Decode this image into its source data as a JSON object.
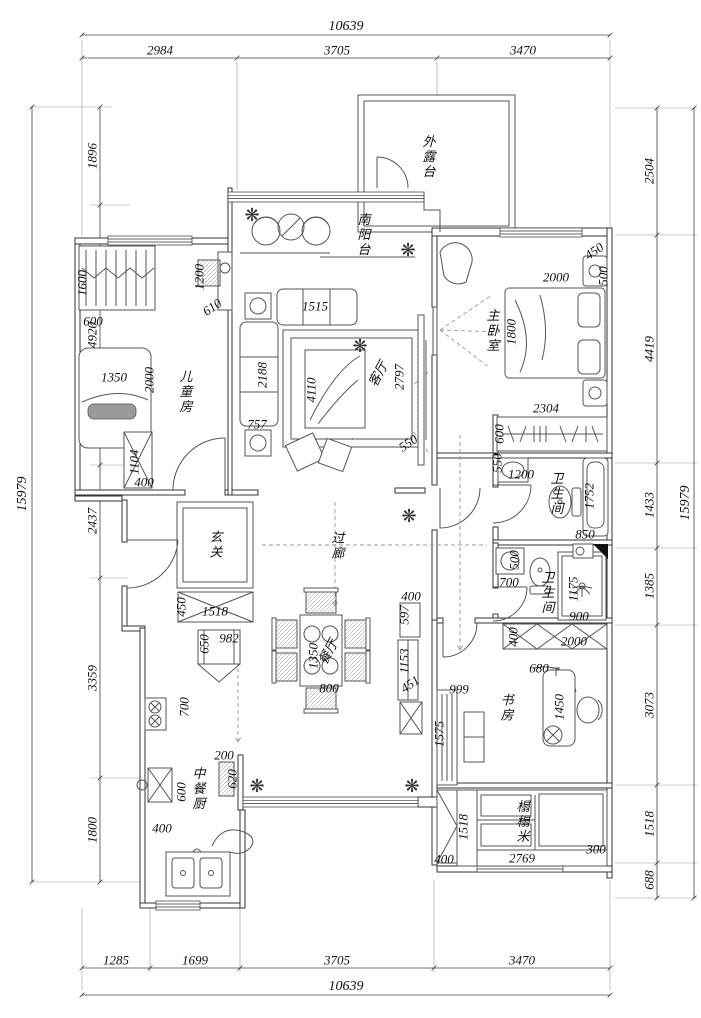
{
  "plan": {
    "rooms": {
      "terrace": "外露台",
      "balcony": "南阳台",
      "master": "主卧室",
      "kids": "儿童房",
      "living": "客厅",
      "entry": "玄关",
      "hall": "过廊",
      "bath_upper": "卫生间",
      "bath_lower": "卫生间",
      "dining": "餐厅",
      "study": "书房",
      "kitchen": "中餐厨",
      "tatami": "榻榻米"
    },
    "dims": {
      "top": {
        "total": "10639",
        "segs": [
          "2984",
          "3705",
          "3470"
        ]
      },
      "bottom": {
        "total": "10639",
        "segs": [
          "1285",
          "1699",
          "3705",
          "3470"
        ]
      },
      "left": {
        "total": "15979",
        "segs": [
          "1896",
          "4920",
          "2437",
          "3359",
          "1800"
        ]
      },
      "right": {
        "total": "15979",
        "segs": [
          "2504",
          "4419",
          "1433",
          "1385",
          "3073",
          "1518",
          "688"
        ]
      },
      "inner": {
        "master": [
          "450",
          "500",
          "2000",
          "1800"
        ],
        "wardrobe": [
          "2304",
          "600"
        ],
        "bath_upper": [
          "550",
          "1200",
          "1752",
          "850"
        ],
        "bath_lower": [
          "500",
          "700",
          "1175",
          "900"
        ],
        "kids": [
          "1600",
          "600",
          "1200",
          "610",
          "1350",
          "2000",
          "1104",
          "400"
        ],
        "living": [
          "1515",
          "2188",
          "4110",
          "757",
          "2797",
          "550"
        ],
        "entry": [
          "450",
          "1518"
        ],
        "dining": [
          "1350",
          "800"
        ],
        "passage": [
          "400",
          "597",
          "1153",
          "451"
        ],
        "study": [
          "400",
          "2000",
          "680",
          "1450",
          "999",
          "1575"
        ],
        "tatami": [
          "1518",
          "400",
          "2769",
          "300"
        ],
        "kitchen": [
          "650",
          "982",
          "700",
          "600",
          "400",
          "200",
          "620"
        ]
      }
    },
    "icons": {
      "plant": "❋"
    }
  }
}
